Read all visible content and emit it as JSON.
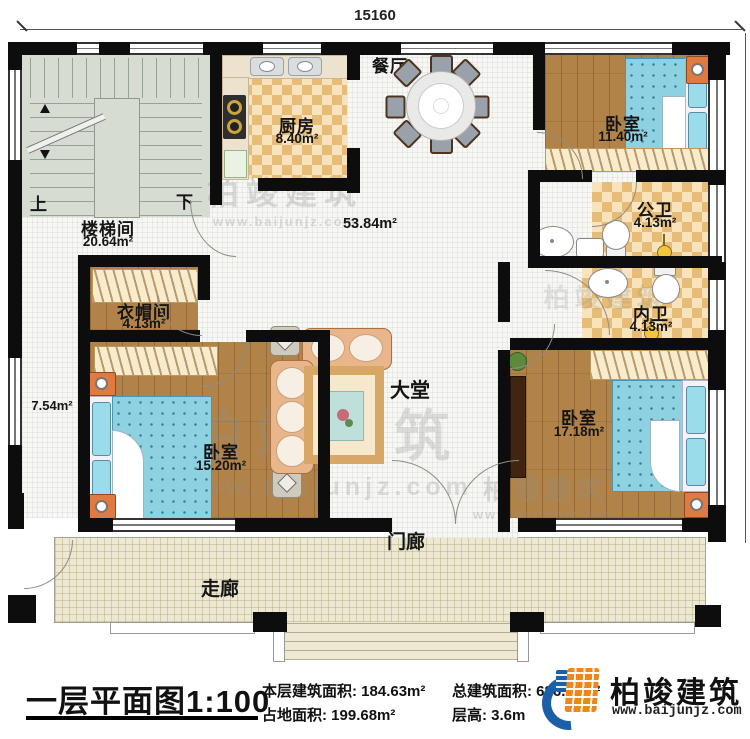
{
  "dimensions": {
    "width_mm": "15160",
    "height_mm": "12800"
  },
  "rooms": {
    "stairwell": {
      "name": "楼梯间",
      "area": "20.64m²",
      "up": "上",
      "down": "下"
    },
    "kitchen": {
      "name": "厨房",
      "area": "8.40m²"
    },
    "dining": {
      "name": "餐厅"
    },
    "bedroom_top": {
      "name": "卧室",
      "area": "11.40m²"
    },
    "public_bath": {
      "name": "公卫",
      "area": "4.13m²"
    },
    "private_bath": {
      "name": "内卫",
      "area": "4.13m²"
    },
    "cloakroom": {
      "name": "衣帽间",
      "area": "4.13m²"
    },
    "bedroom_left": {
      "name": "卧室",
      "area": "15.20m²"
    },
    "bedroom_right": {
      "name": "卧室",
      "area": "17.18m²"
    },
    "hall": {
      "name": "大堂"
    },
    "porch": {
      "name": "门廊"
    },
    "veranda": {
      "name": "走廊"
    },
    "open_area": "53.84m²",
    "side_corridor_area": "7.54m²"
  },
  "title_block": {
    "title": "一层平面图",
    "scale": "1:100",
    "stats": [
      {
        "label": "本层建筑面积:",
        "value": "184.63m²"
      },
      {
        "label": "占地面积:",
        "value": "199.68m²"
      },
      {
        "label": "总建筑面积:",
        "value": "686.50m²"
      },
      {
        "label": "层高:",
        "value": "3.6m"
      }
    ]
  },
  "brand": {
    "name": "柏竣建筑",
    "website": "www.baijunjz.com"
  },
  "colors": {
    "brand_blue": "#1a5fa8",
    "brand_orange": "#f08519",
    "wall": "#0d0d0d",
    "wood_floor": "#b28349",
    "bed_blue": "#8ed2e2",
    "checker_tan": "#e7bc76",
    "veranda_tile": "#ece8d1"
  }
}
